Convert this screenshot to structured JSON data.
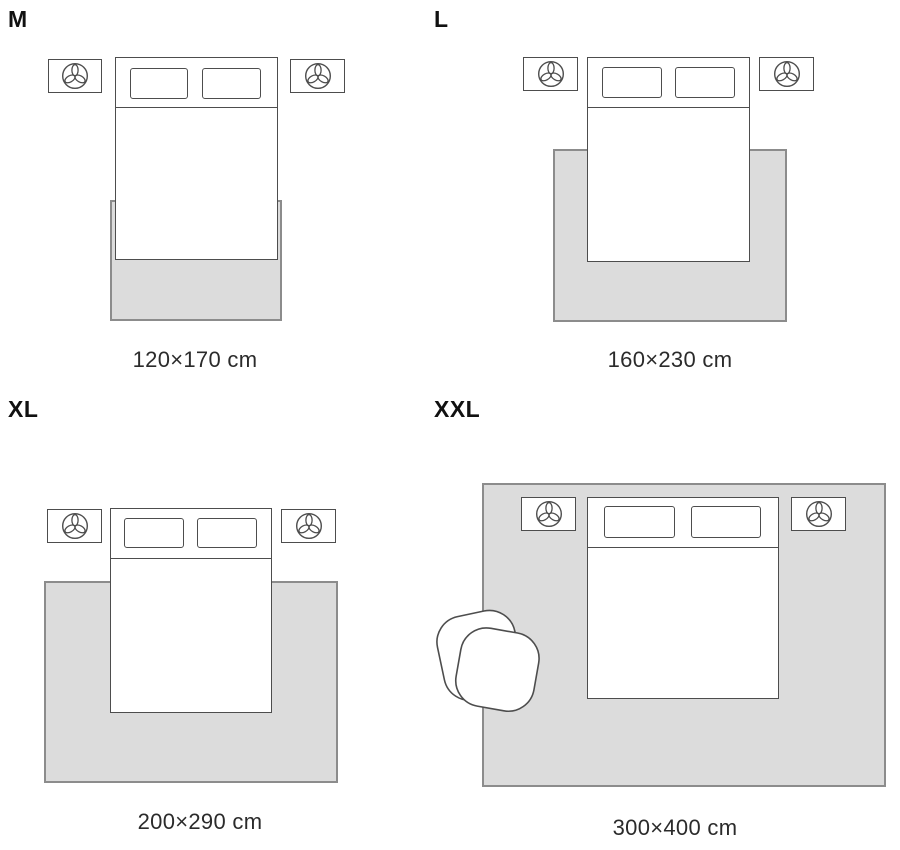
{
  "title": "Rug size guide — bedroom layouts",
  "colors": {
    "background": "#ffffff",
    "rug_fill": "#dcdcdc",
    "rug_border": "#8c8c8c",
    "furniture_line": "#4d4d4d",
    "label_text": "#111111",
    "dimension_text": "#2b2b2b"
  },
  "icons": {
    "nightstand_icon": "plant-top-view-icon",
    "xxl_seat_icon": "armchair-top-view-icon"
  },
  "panels": [
    {
      "id": "m",
      "label": "M",
      "size": "120×170 cm"
    },
    {
      "id": "l",
      "label": "L",
      "size": "160×230 cm"
    },
    {
      "id": "xl",
      "label": "XL",
      "size": "200×290 cm"
    },
    {
      "id": "xxl",
      "label": "XXL",
      "size": "300×400 cm"
    }
  ]
}
